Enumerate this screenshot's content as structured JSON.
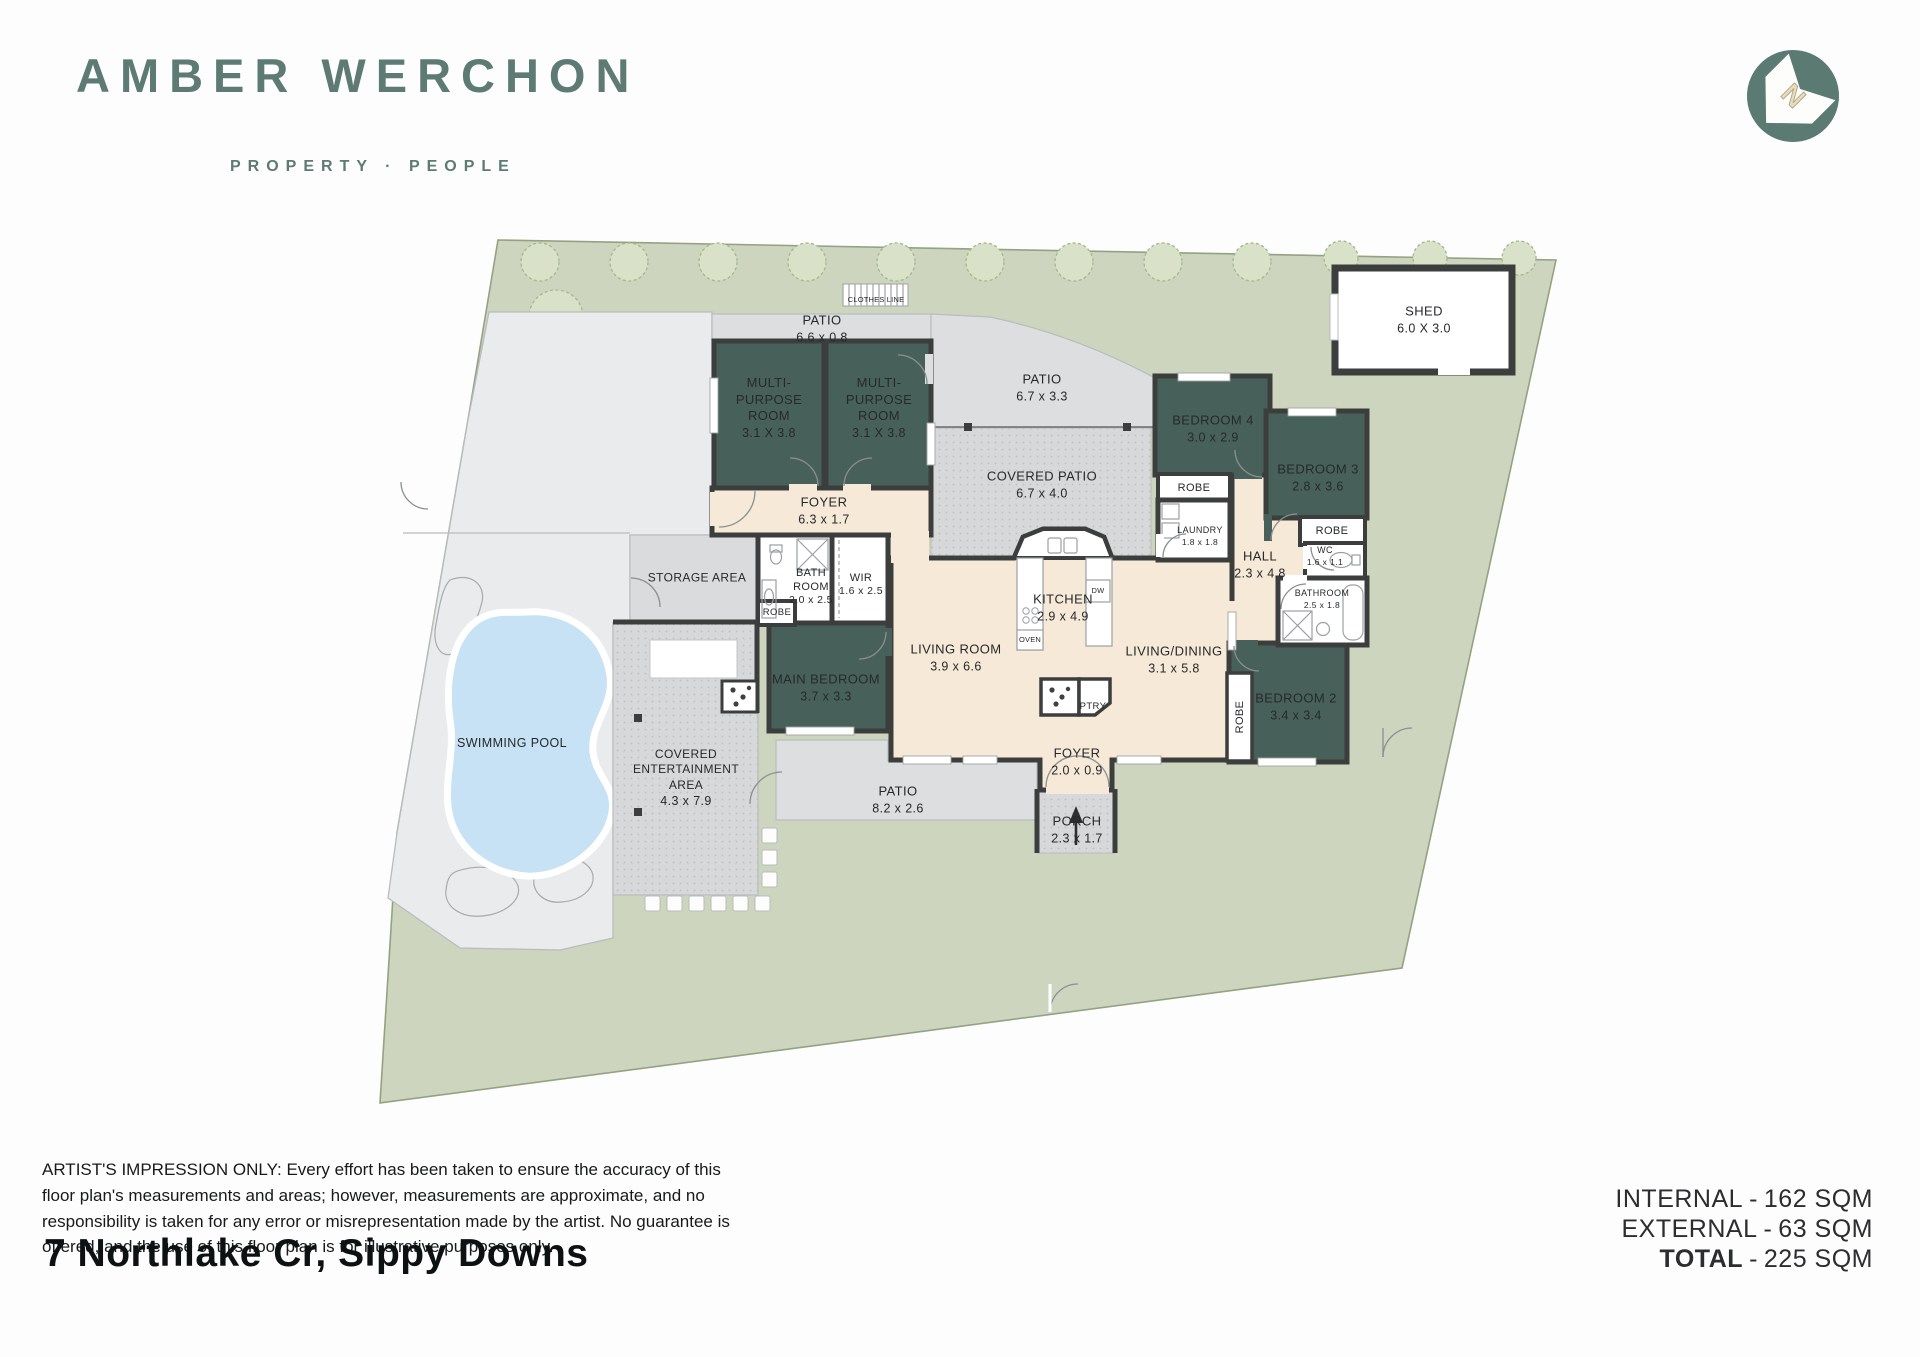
{
  "brand": {
    "name": "AMBER WERCHON",
    "tagline": "PROPERTY · PEOPLE"
  },
  "compass": {
    "letter": "N"
  },
  "labels": {
    "patio_top": {
      "name": "PATIO",
      "dims": "6.6 x 0.8"
    },
    "clothes_line": {
      "name": "CLOTHES LINE"
    },
    "mp1": {
      "name": "MULTI-PURPOSE ROOM",
      "dims": "3.1 X 3.8"
    },
    "mp2": {
      "name": "MULTI-PURPOSE ROOM",
      "dims": "3.1 X 3.8"
    },
    "foyer_rear": {
      "name": "FOYER",
      "dims": "6.3 x 1.7"
    },
    "patio_mid": {
      "name": "PATIO",
      "dims": "6.7 x 3.3"
    },
    "covered_patio": {
      "name": "COVERED PATIO",
      "dims": "6.7 x 4.0"
    },
    "bedroom4": {
      "name": "BEDROOM 4",
      "dims": "3.0 x 2.9"
    },
    "robe4": {
      "name": "ROBE"
    },
    "laundry": {
      "name": "LAUNDRY",
      "dims": "1.8 x 1.8"
    },
    "bedroom3": {
      "name": "BEDROOM 3",
      "dims": "2.8 x 3.6"
    },
    "robe3": {
      "name": "ROBE"
    },
    "hall": {
      "name": "HALL",
      "dims": "2.3 x 4.8"
    },
    "wc": {
      "name": "WC",
      "dims": "1.6 x 1.1"
    },
    "bathroom2": {
      "name": "BATHROOM",
      "dims": "2.5 x 1.8"
    },
    "storage": {
      "name": "STORAGE AREA"
    },
    "bathroom": {
      "name": "BATH ROOM",
      "dims": "2.0 x 2.5"
    },
    "wir": {
      "name": "WIR",
      "dims": "1.6 x 2.5"
    },
    "robe_main": {
      "name": "ROBE"
    },
    "kitchen": {
      "name": "KITCHEN",
      "dims": "2.9 x 4.9"
    },
    "dw": {
      "name": "DW"
    },
    "oven": {
      "name": "OVEN"
    },
    "ptry": {
      "name": "PTRY"
    },
    "living": {
      "name": "LIVING ROOM",
      "dims": "3.9 x 6.6"
    },
    "livingdining": {
      "name": "LIVING/DINING",
      "dims": "3.1 x 5.8"
    },
    "main_bedroom": {
      "name": "MAIN BEDROOM",
      "dims": "3.7 x 3.3"
    },
    "bedroom2": {
      "name": "BEDROOM 2",
      "dims": "3.4 x 3.4"
    },
    "robe2": {
      "name": "ROBE"
    },
    "foyer_front": {
      "name": "FOYER",
      "dims": "2.0 x 0.9"
    },
    "porch": {
      "name": "PORCH",
      "dims": "2.3 x 1.7"
    },
    "patio_bottom": {
      "name": "PATIO",
      "dims": "8.2 x 2.6"
    },
    "entertainment": {
      "name": "COVERED ENTERTAINMENT AREA",
      "dims": "4.3 x 7.9"
    },
    "pool": {
      "name": "SWIMMING POOL"
    },
    "shed": {
      "name": "SHED",
      "dims": "6.0 X 3.0"
    }
  },
  "areas": [
    {
      "label": "INTERNAL",
      "sep": "-",
      "value": "162 SQM"
    },
    {
      "label": "EXTERNAL",
      "sep": "-",
      "value": "63 SQM"
    },
    {
      "label": "TOTAL",
      "sep": "-",
      "value": "225 SQM"
    }
  ],
  "disclaimer": {
    "lead": "ARTIST'S IMPRESSION ONLY:",
    "body": " Every effort has been taken to ensure the accuracy of this floor plan's measurements and areas; however, measurements are approximate, and no responsibility is taken for any error or misrepresentation made by the artist. No guarantee is offered, and the use of this floor plan is for illustrative purposes only."
  },
  "address": "7 Northlake Cr, Sippy Downs",
  "colors": {
    "brand_green": "#5d7b73",
    "room_dark": "#47615a",
    "interior_cream": "#f7e9d7",
    "lot_green": "#cdd5bf",
    "pool_blue": "#c6e2f4"
  }
}
